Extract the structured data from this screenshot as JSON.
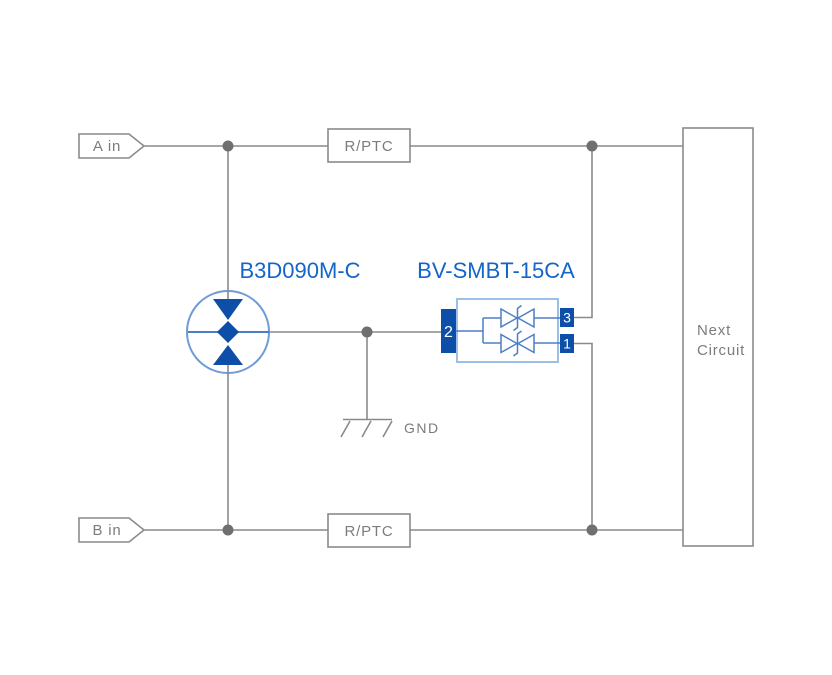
{
  "diagram": {
    "inputs": {
      "a_label": "A in",
      "b_label": "B in"
    },
    "series_elements": {
      "top_label": "R/PTC",
      "bottom_label": "R/PTC"
    },
    "gdt": {
      "name": "B3D090M-C"
    },
    "tvs": {
      "name": "BV-SMBT-15CA",
      "pin_left": "2",
      "pin_top_right": "3",
      "pin_bottom_right": "1"
    },
    "ground_label": "GND",
    "next_circuit": {
      "line1": "Next",
      "line2": "Circuit"
    }
  },
  "colors": {
    "background": "#ffffff",
    "wire_gray": "#8a8a8a",
    "text_gray": "#7c7c7c",
    "junction_gray": "#6f6f6f",
    "label_blue": "#1565c8",
    "component_blue": "#0d4fa8",
    "gdt_outline_blue": "#6f9cd6",
    "gdt_line_blue": "#4a7cc7",
    "tvs_body_blue": "#9cbfe6",
    "tvs_inner_blue": "#4d7fc4"
  }
}
